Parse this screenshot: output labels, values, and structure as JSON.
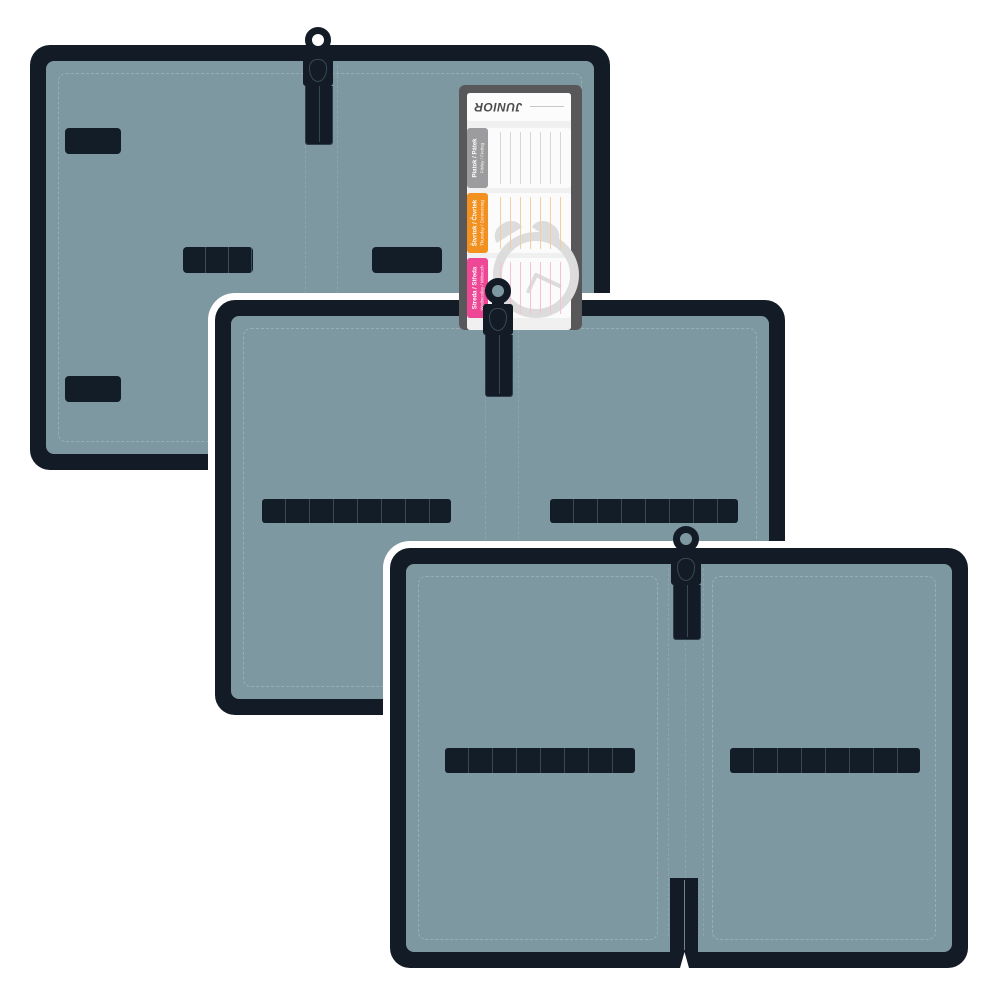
{
  "product": {
    "items": [
      "folder-back",
      "folder-middle",
      "folder-front"
    ],
    "colors": {
      "background": "#ffffff",
      "folder_border": "#131c26",
      "folder_fabric": "#7e98a1",
      "stitching": "#a3b7bd",
      "strap": "#131d27",
      "outline_gap": "#ffffff"
    }
  },
  "brand_card": {
    "brand": "JUNIOR",
    "card_frame_color": "#58585a",
    "card_bg_color": "#f0f0f0",
    "watermark": "alarm-clock",
    "watermark_color": "#dcdcdc",
    "rows": [
      {
        "day": "Piatok / Pátek",
        "sub": "Friday / Freitag",
        "tab_color": "#9c9c9e",
        "stripe_color": "#d6d6d6"
      },
      {
        "day": "Štvrtok / Čtvrtek",
        "sub": "Thursday / Donnerstag",
        "tab_color": "#f2911f",
        "stripe_color": "#f4cf9d"
      },
      {
        "day": "Streda / Středa",
        "sub": "Wednesday / Mittwoch",
        "tab_color": "#ee4796",
        "stripe_color": "#f6c0d9"
      }
    ]
  },
  "icons": {
    "zipper_pull": "zipper-pull-icon",
    "alarm_clock": "alarm-clock-icon"
  }
}
